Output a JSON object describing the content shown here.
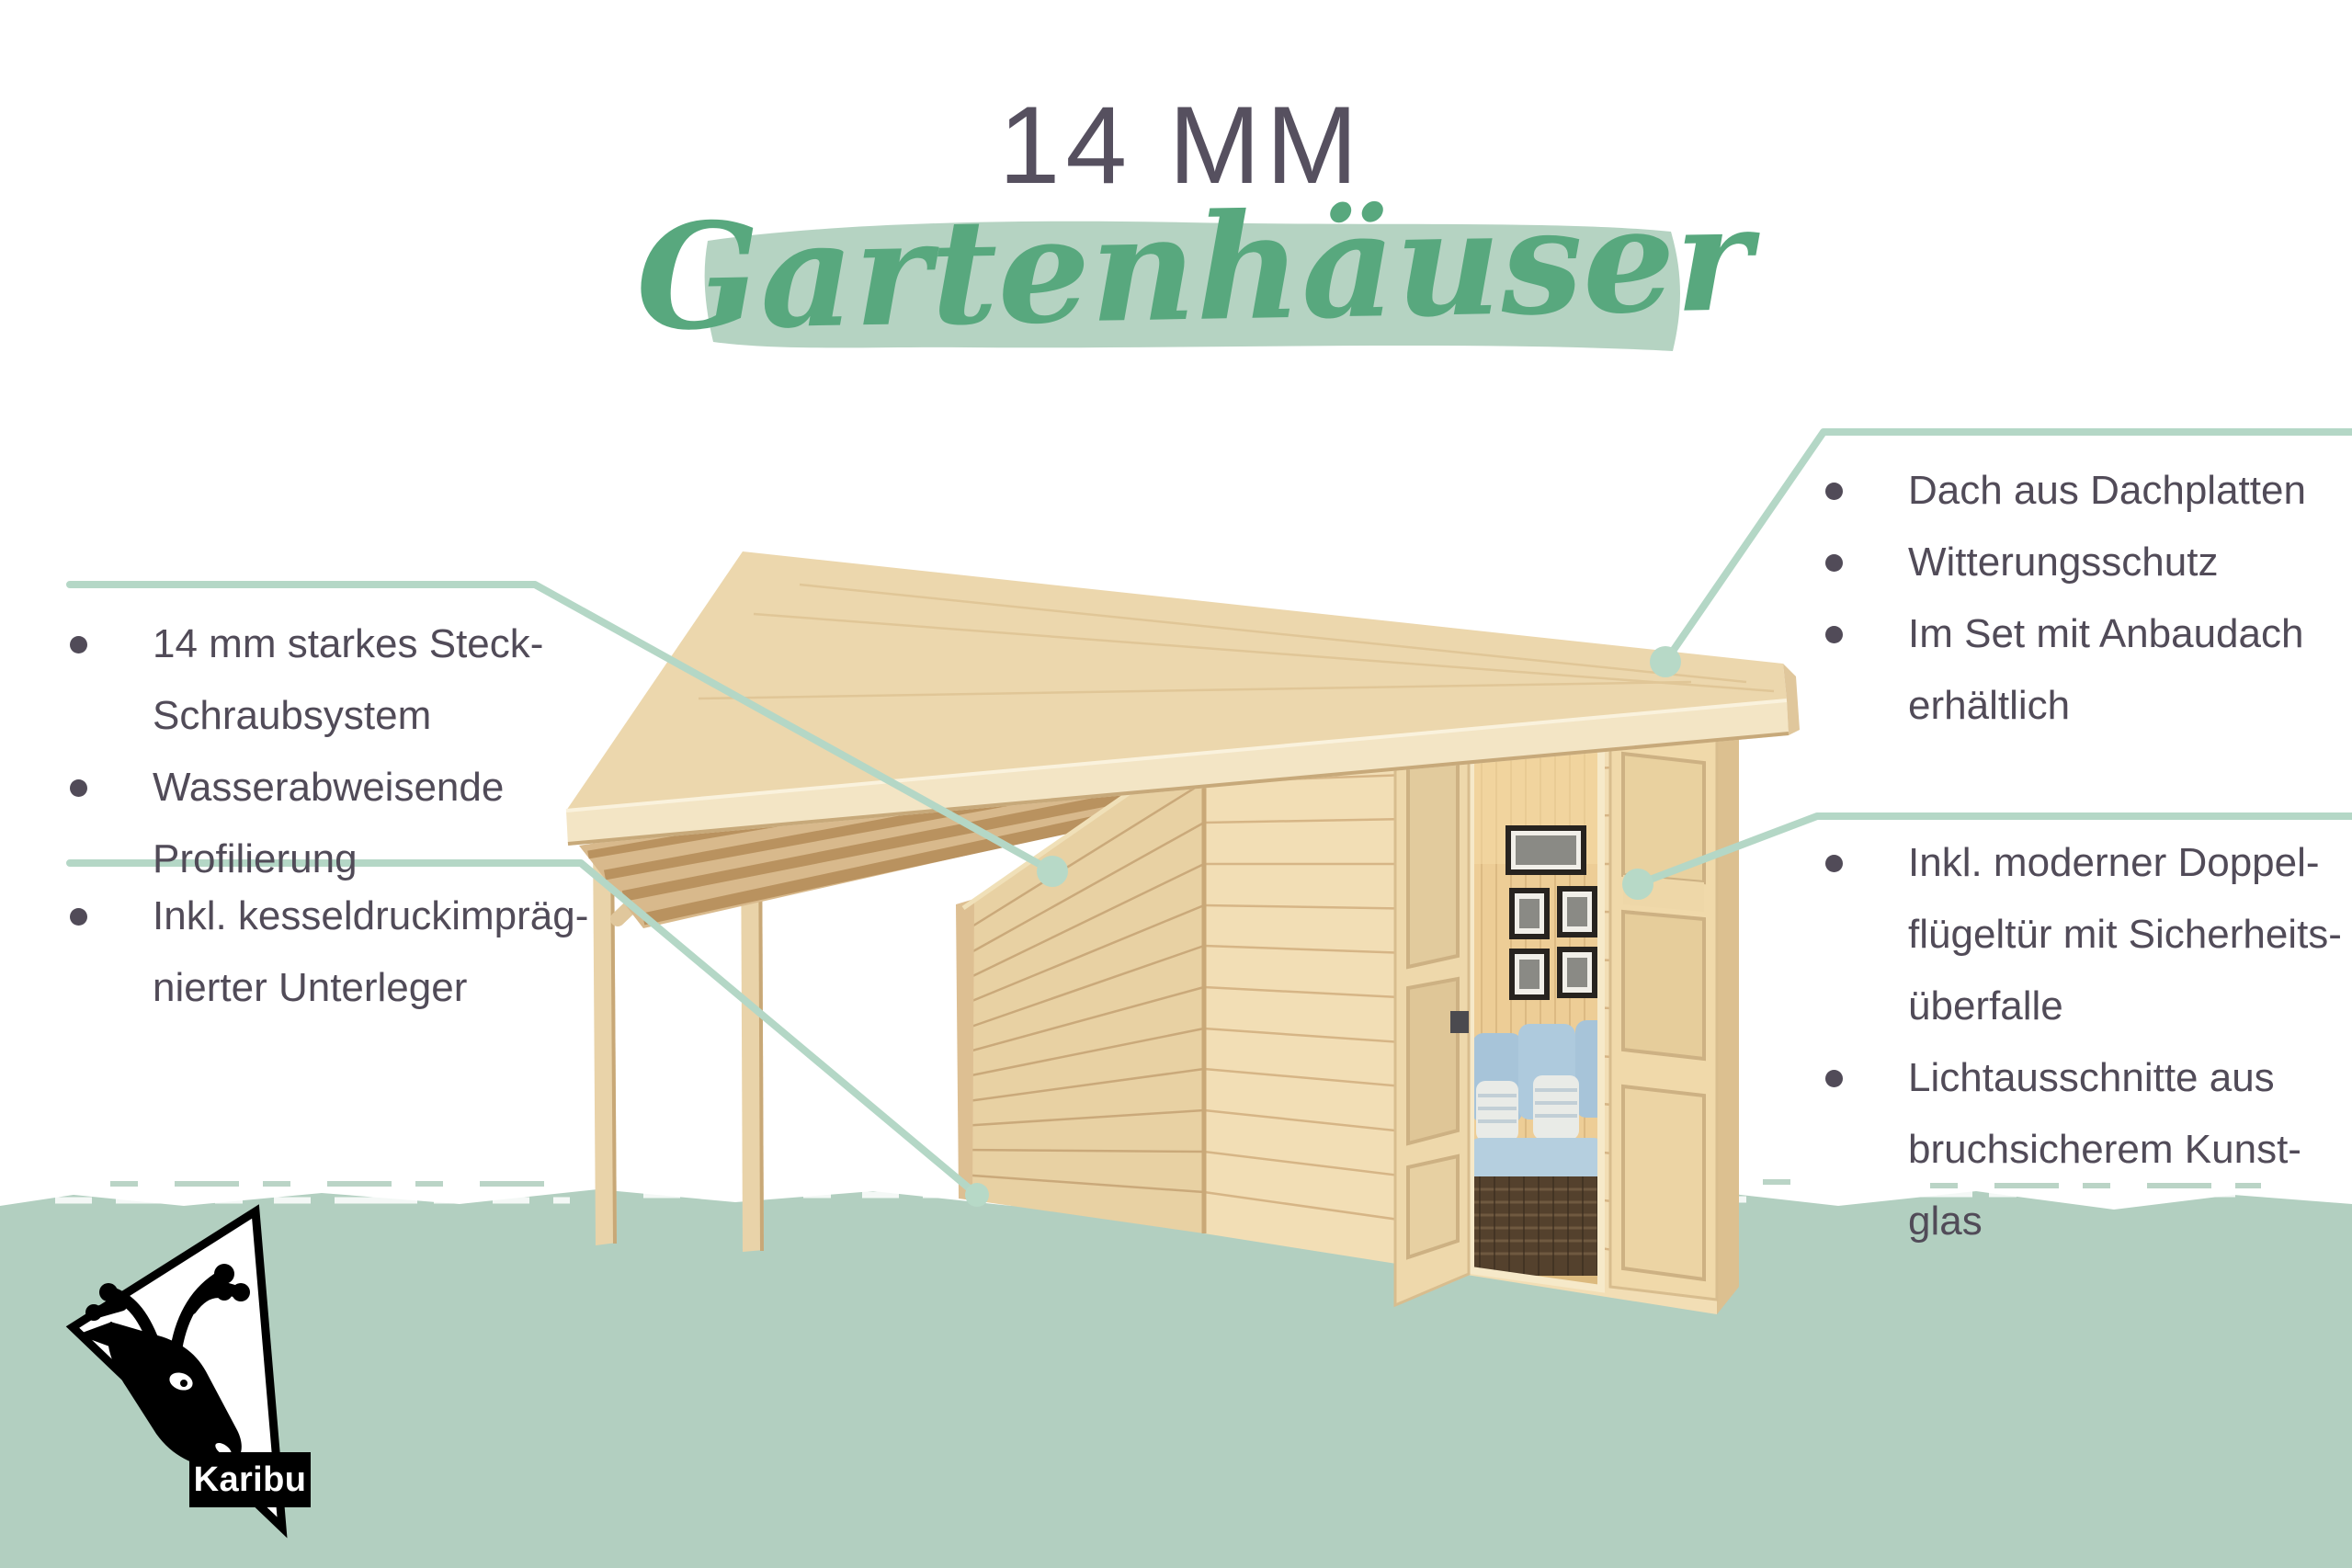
{
  "title": {
    "small": "14 MM",
    "script": "Gartenhäuser"
  },
  "features": {
    "left_top": {
      "items": [
        {
          "lines": [
            "14 mm starkes Steck-",
            "Schraubsystem"
          ]
        },
        {
          "lines": [
            "Wasserabweisende",
            "Profilierung"
          ]
        }
      ]
    },
    "left_bottom": {
      "items": [
        {
          "lines": [
            "Inkl. kesseldruckimpräg-",
            "nierter Unterleger"
          ]
        }
      ]
    },
    "right_top": {
      "items": [
        {
          "lines": [
            "Dach aus Dachplatten"
          ]
        },
        {
          "lines": [
            "Witterungsschutz"
          ]
        },
        {
          "lines": [
            "Im Set mit Anbaudach",
            "erhältlich"
          ]
        }
      ]
    },
    "right_bottom": {
      "items": [
        {
          "lines": [
            "Inkl. moderner Doppel-",
            "flügeltür mit Sicherheits-",
            "überfalle"
          ]
        },
        {
          "lines": [
            "Lichtausschnitte aus",
            "bruchsicherem Kunst-",
            "glas"
          ]
        }
      ]
    }
  },
  "logo": {
    "brand": "Karibu"
  },
  "colors": {
    "text": "#514b58",
    "title_small": "#56505f",
    "script_green": "#58a87e",
    "title_brush": "#b5d3c2",
    "callout_line": "#b4d7c6",
    "callout_circle": "#b7d9c7",
    "ground_band": "#b2cfc0",
    "wood_roof": "#ecd7ad",
    "wood_fascia": "#f3e5c5",
    "wood_side_wall": "#e8d1a3",
    "wood_front_wall": "#f2deb5",
    "interior_wall": "#edcd96",
    "sofa_blue": "#a7c4d9",
    "rattan_brown": "#54412d",
    "logo_black": "#000000"
  }
}
